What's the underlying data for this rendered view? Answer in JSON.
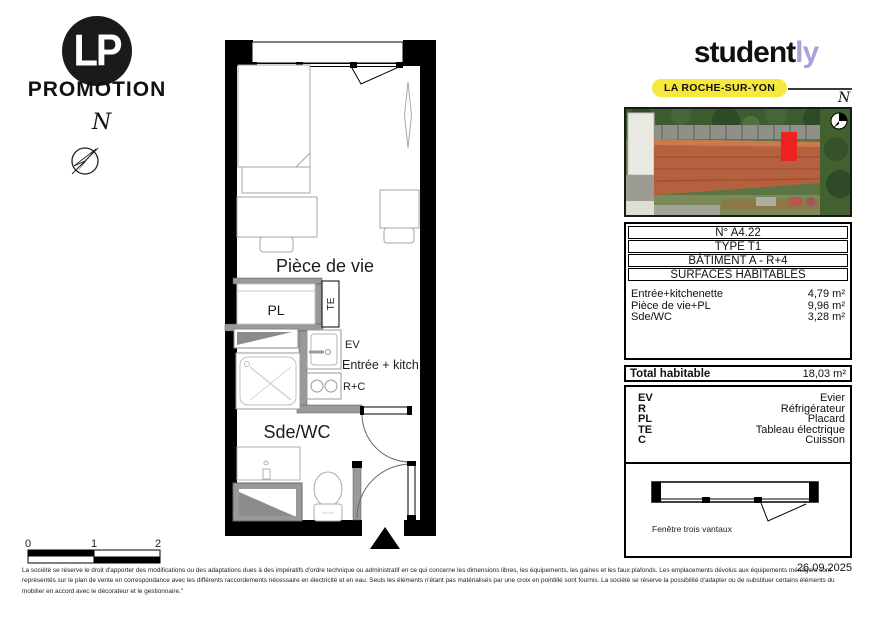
{
  "branding": {
    "lp_circle": "LP",
    "lp_name": "PROMOTION",
    "north": "N"
  },
  "studently": {
    "black": "student",
    "purple": "ly",
    "accent_color": "#a8a2d9",
    "badge": "LA ROCHE-SUR-YON",
    "badge_color": "#f6e93b",
    "north": "N"
  },
  "site_photo": {
    "marker_color": "#ee2020",
    "description": "aerial-view-building-with-unit-highlighted"
  },
  "plan_labels": {
    "living": "Pièce de vie",
    "closet": "PL",
    "electrical": "TE",
    "sink": "EV",
    "entry": "Entrée + kitch.",
    "fridge_cooking": "R+C",
    "bathroom": "Sde/WC"
  },
  "scale_bar": {
    "labels": [
      "0",
      "1",
      "2"
    ]
  },
  "unit_card": {
    "rows": [
      "N° A4.22",
      "TYPE T1",
      "BÂTIMENT A - R+4",
      "SURFACES HABITABLES"
    ],
    "surfaces": [
      {
        "label": "Entrée+kitchenette",
        "value": "4,79 m²"
      },
      {
        "label": "Pièce de vie+PL",
        "value": "9,96 m²"
      },
      {
        "label": "Sde/WC",
        "value": "3,28 m²"
      }
    ],
    "total_label": "Total habitable",
    "total_value": "18,03 m²"
  },
  "legend": [
    {
      "key": "EV",
      "value": "Evier"
    },
    {
      "key": "R",
      "value": "Réfrigérateur"
    },
    {
      "key": "PL",
      "value": "Placard"
    },
    {
      "key": "TE",
      "value": "Tableau électrique"
    },
    {
      "key": "C",
      "value": "Cuisson"
    }
  ],
  "window_detail": {
    "caption": "Fenêtre trois vantaux"
  },
  "date": "26.09.2025",
  "disclaimer": "La société se réserve le droit d'apporter des modifications ou des adaptations dues à des impératifs d'ordre technique ou administratif en ce qui concerne les dimensions libres, les équipements, les gaines et les faux plafonds. Les emplacements dévolus aux équipements ménagers sont représentés sur le plan de vente en correspondance avec les différents raccordements nécessaire en électricité et en eau. Seuls les éléments n'étant pas matérialisés par une croix en pointillé sont fournis. La société se réserve la possibilité d'adapter ou de substituer certains éléments du mobilier en accord avec le décorateur et le gestionnaire.\""
}
